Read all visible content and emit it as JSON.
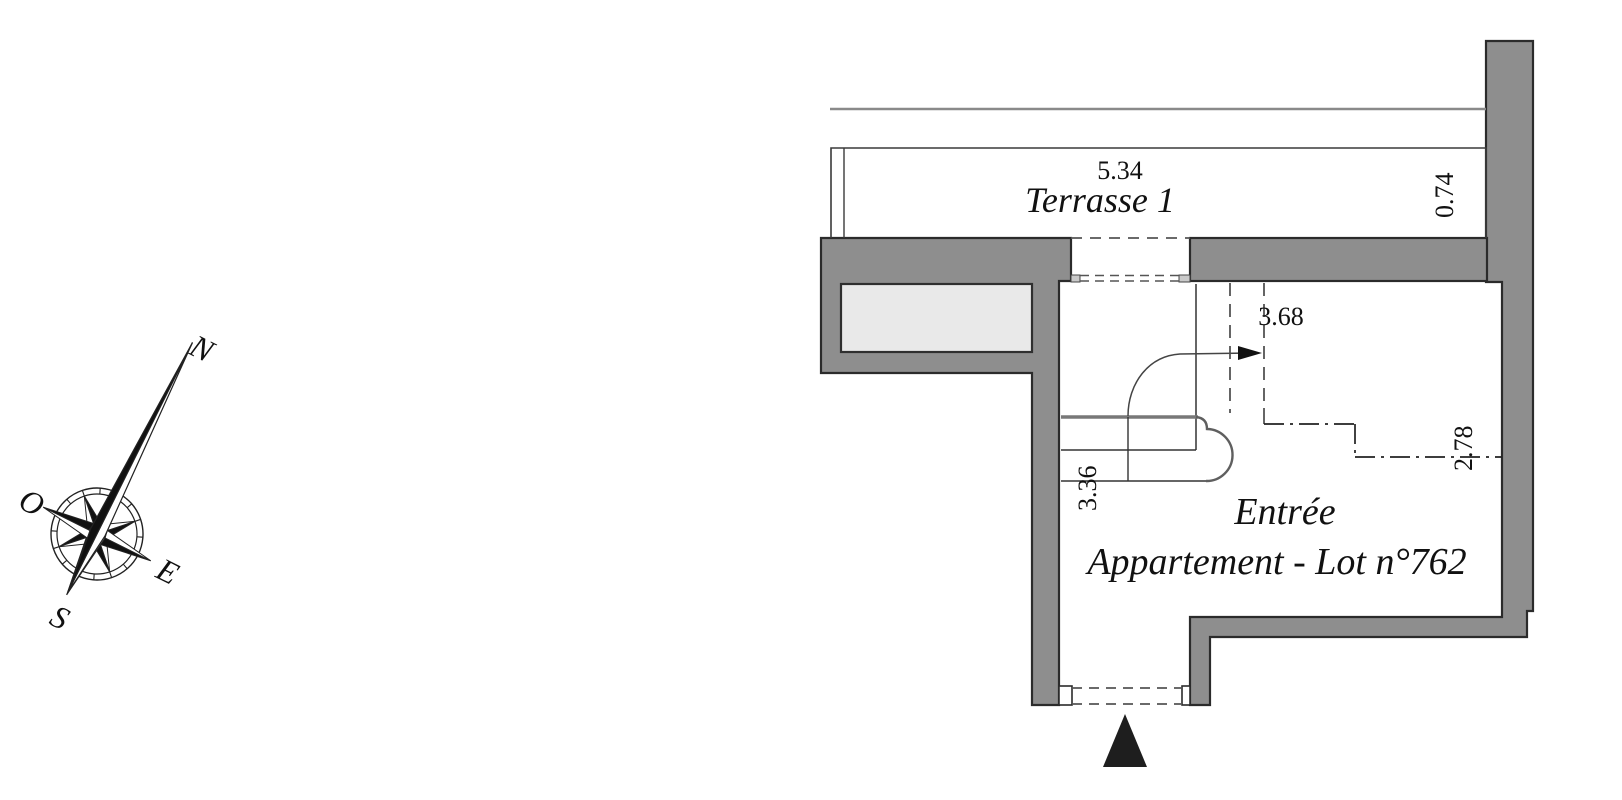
{
  "compass": {
    "north": "N",
    "west": "O",
    "east": "E",
    "south": "S"
  },
  "plan": {
    "terrace": {
      "name": "Terrasse 1",
      "width": "5.34",
      "depth": "0.74"
    },
    "entry": {
      "name_line1": "Entrée",
      "name_line2": "Appartement - Lot n°762",
      "dim_door": "3.68",
      "dim_left": "3.36",
      "dim_right": "2.78"
    }
  },
  "colors": {
    "wall_fill": "#8e8e8e",
    "shaft_fill": "#e9e9e9",
    "jamb_fill": "#c9c9c9",
    "outline": "#2b2b2b",
    "thin_line": "#333333",
    "dash_line": "#555555",
    "entrance_marker": "#1e1e1e",
    "top_line": "#8a8a8a"
  }
}
